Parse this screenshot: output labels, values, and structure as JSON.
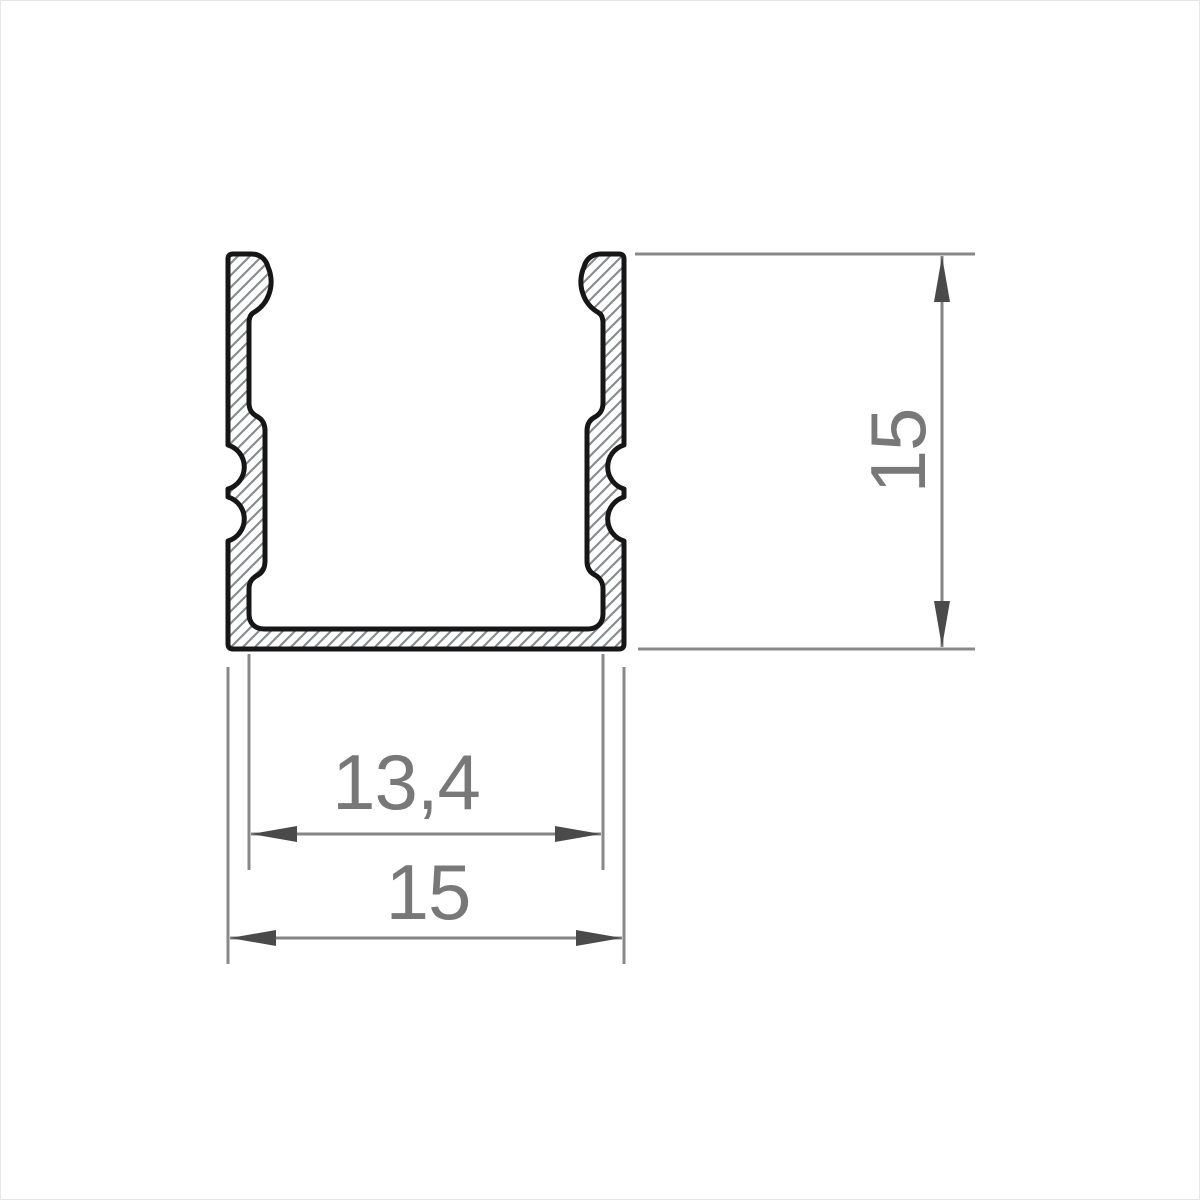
{
  "drawing": {
    "type": "profile-cross-section",
    "labels": {
      "inner_width": "13,4",
      "outer_width": "15",
      "height": "15"
    },
    "values": {
      "inner_width": 13.4,
      "outer_width": 15,
      "height": 15
    },
    "colors": {
      "background": "#ffffff",
      "outline": "#161616",
      "hatch": "#8a8d90",
      "dim_line": "#858585",
      "arrow": "#4a4a4a",
      "text": "#787878"
    }
  }
}
